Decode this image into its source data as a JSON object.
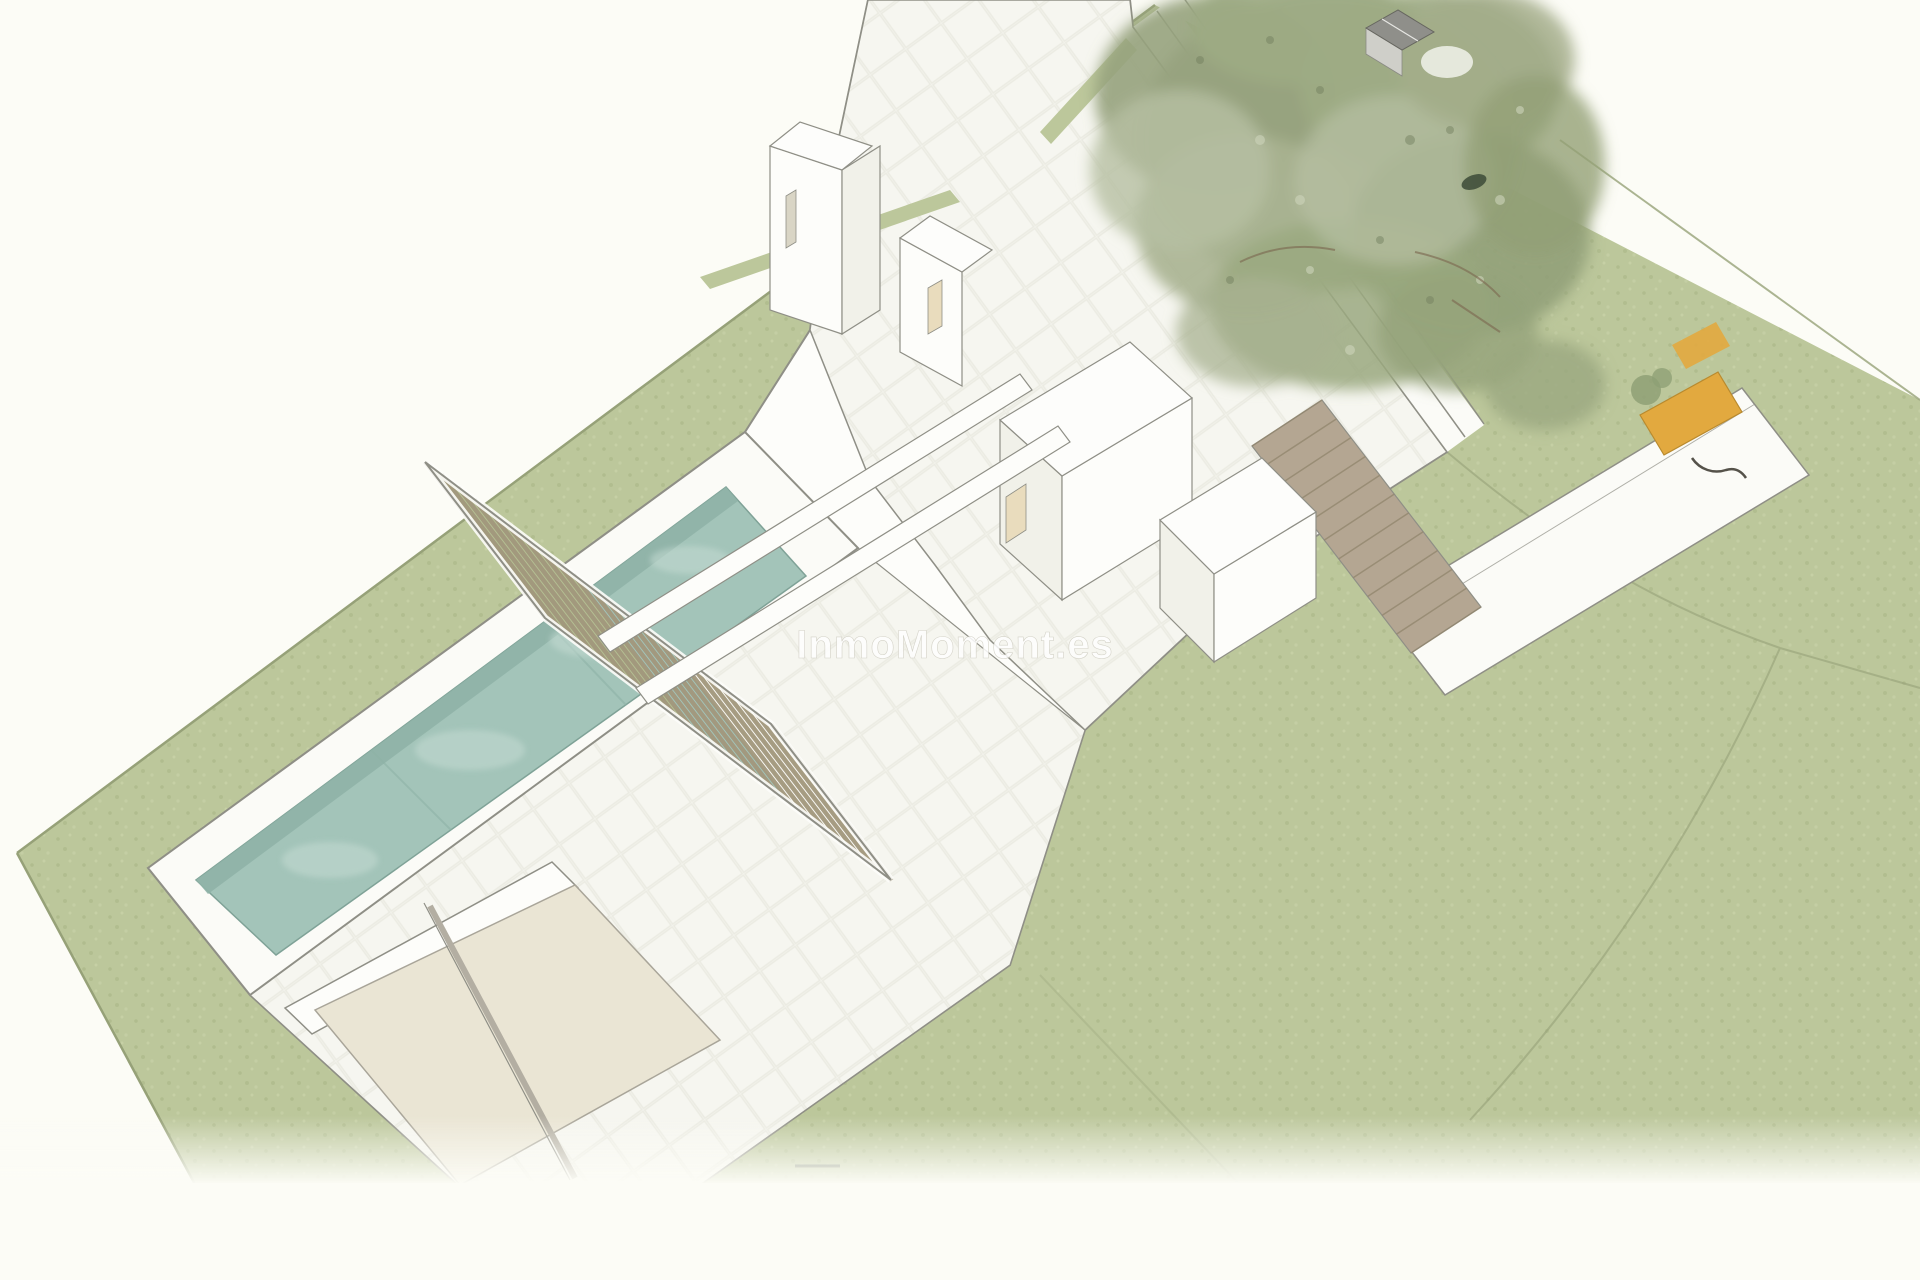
{
  "scene": {
    "type": "architectural-aerial-3d-render",
    "description": "Aerial SketchUp-style 3D rendering of a modern flat-roof villa parcel: sage-green lawn plot, lap pool with white surrounding deck, slatted timber pergola, white tiled roof terraces, rooftop cube volumes, louvered access ramp, sun deck with yellow lounger, large pine tree with small grey shed in the top-right corner"
  },
  "watermark": {
    "text": "InmoMoment.es",
    "color": "#ffffff",
    "opacity": 0.85
  },
  "pergola": {
    "slat_count": 22
  },
  "ramp": {
    "stripe_count": 12
  },
  "colors": {
    "background": "#fcfcf6",
    "lawn": "#bcc79b",
    "lawn_speckle_dark": "#adb98b",
    "lawn_speckle_light": "#c8d2a8",
    "lawn_line": "#96a178",
    "outline": "#8f8f86",
    "deck_white": "#fbfbf7",
    "roof_white": "#f6f6f0",
    "tile_line": "#ebebe2",
    "wall_white": "#fdfdfa",
    "wall_side": "#f1f1e9",
    "pool_water": "#a3c4b9",
    "pool_water_edge": "#8fb3a7",
    "pool_highlight": "#c5dbd3",
    "pergola_slat": "#a2977c",
    "terrace_cream": "#eae5d4",
    "window_cream": "#e9dcbd",
    "wall_gray": "#b3aea2",
    "ramp_fill": "#b4a692",
    "ramp_line": "#93876f",
    "tree_green_dark": "#8f9d77",
    "tree_green_mid": "#a3ad8a",
    "tree_green_light": "#b6bfa2",
    "branch_brown": "#7d6a52",
    "shed_roof_gray": "#8f8f8a",
    "shed_wall": "#cfcfc9",
    "lounger_yellow": "#e2a93f",
    "plant_green": "#8fa075",
    "squiggle_dark": "#55524a"
  }
}
